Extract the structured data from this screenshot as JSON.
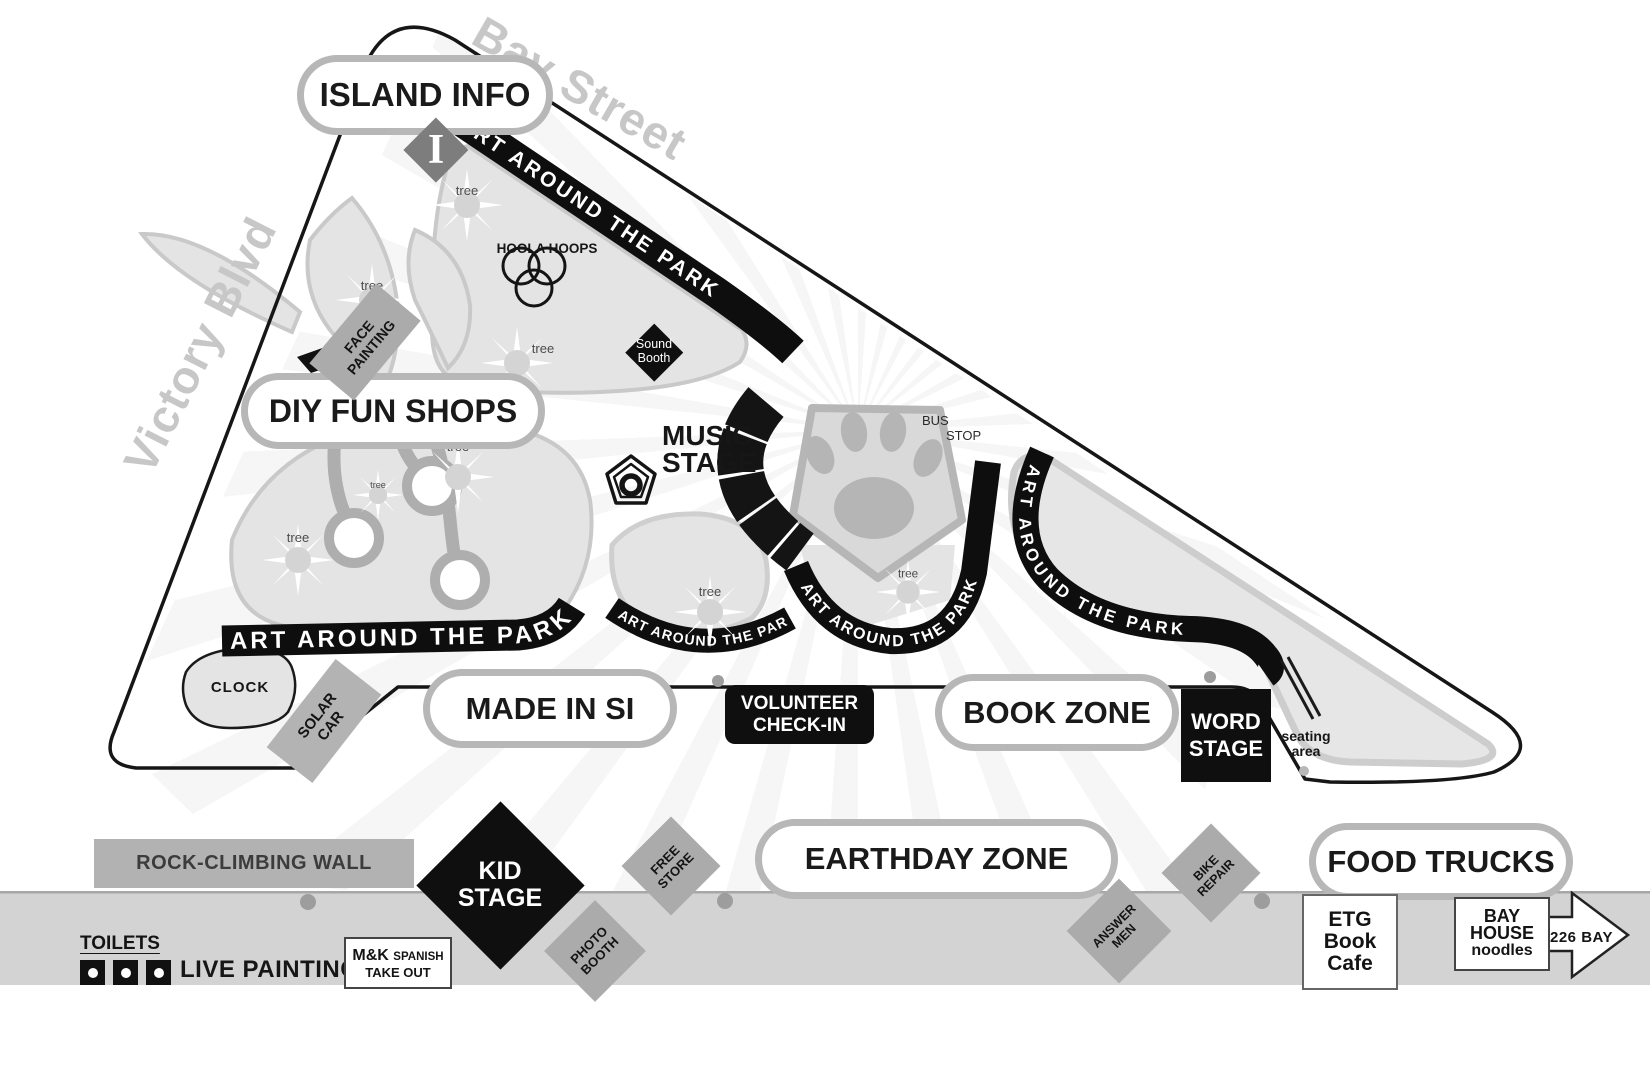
{
  "streets": {
    "bay": "Bay Street",
    "victory": "Victory Blvd"
  },
  "zones": {
    "island_info": "ISLAND INFO",
    "diy_fun_shops": "DIY FUN SHOPS",
    "made_in_si": "MADE IN SI",
    "book_zone": "BOOK ZONE",
    "earthday_zone": "EARTHDAY ZONE",
    "food_trucks": "FOOD TRUCKS"
  },
  "stages": {
    "music": "MUSIC\nSTAGE",
    "kid": "KID\nSTAGE",
    "word": "WORD\nSTAGE",
    "volunteer": "VOLUNTEER\nCHECK-IN",
    "sound_booth": "Sound\nBooth"
  },
  "ribbon_text": "ART AROUND THE PARK",
  "booths": {
    "face_painting": "FACE\nPAINTING",
    "solar_car": "SOLAR\nCAR",
    "photo_booth": "PHOTO\nBOOTH",
    "free_store": "FREE\nSTORE",
    "answer_men": "ANSWER\nMEN",
    "bike_repair": "BIKE\nREPAIR"
  },
  "features": {
    "hoola_hoops": "HOOLA HOOPS",
    "bus": "BUS",
    "stop": "STOP",
    "clock": "CLOCK",
    "seating_area": "seating\narea",
    "tree": "tree",
    "info_marker": "I",
    "rock_climbing_wall": "ROCK-CLIMBING WALL",
    "toilets": "TOILETS",
    "live_painting": "LIVE PAINTING"
  },
  "vendors": {
    "mk_name": "M&K",
    "mk_cuisine": "SPANISH",
    "mk_line2": "TAKE OUT",
    "etg_book_cafe": "ETG\nBook\nCafe",
    "bay_house": "BAY\nHOUSE",
    "bay_house_sub": "noodles",
    "arrow_label": "226 BAY"
  },
  "colors": {
    "ink": "#141414",
    "lawn": "#e4e4e5",
    "lawn_edge": "#c9c9c9",
    "street_band": "#d3d3d3",
    "gray_booth": "#ababab",
    "pill_border": "#b7b7b7",
    "street_text": "#c7c7c7",
    "info_gray": "#7d7d7d"
  }
}
